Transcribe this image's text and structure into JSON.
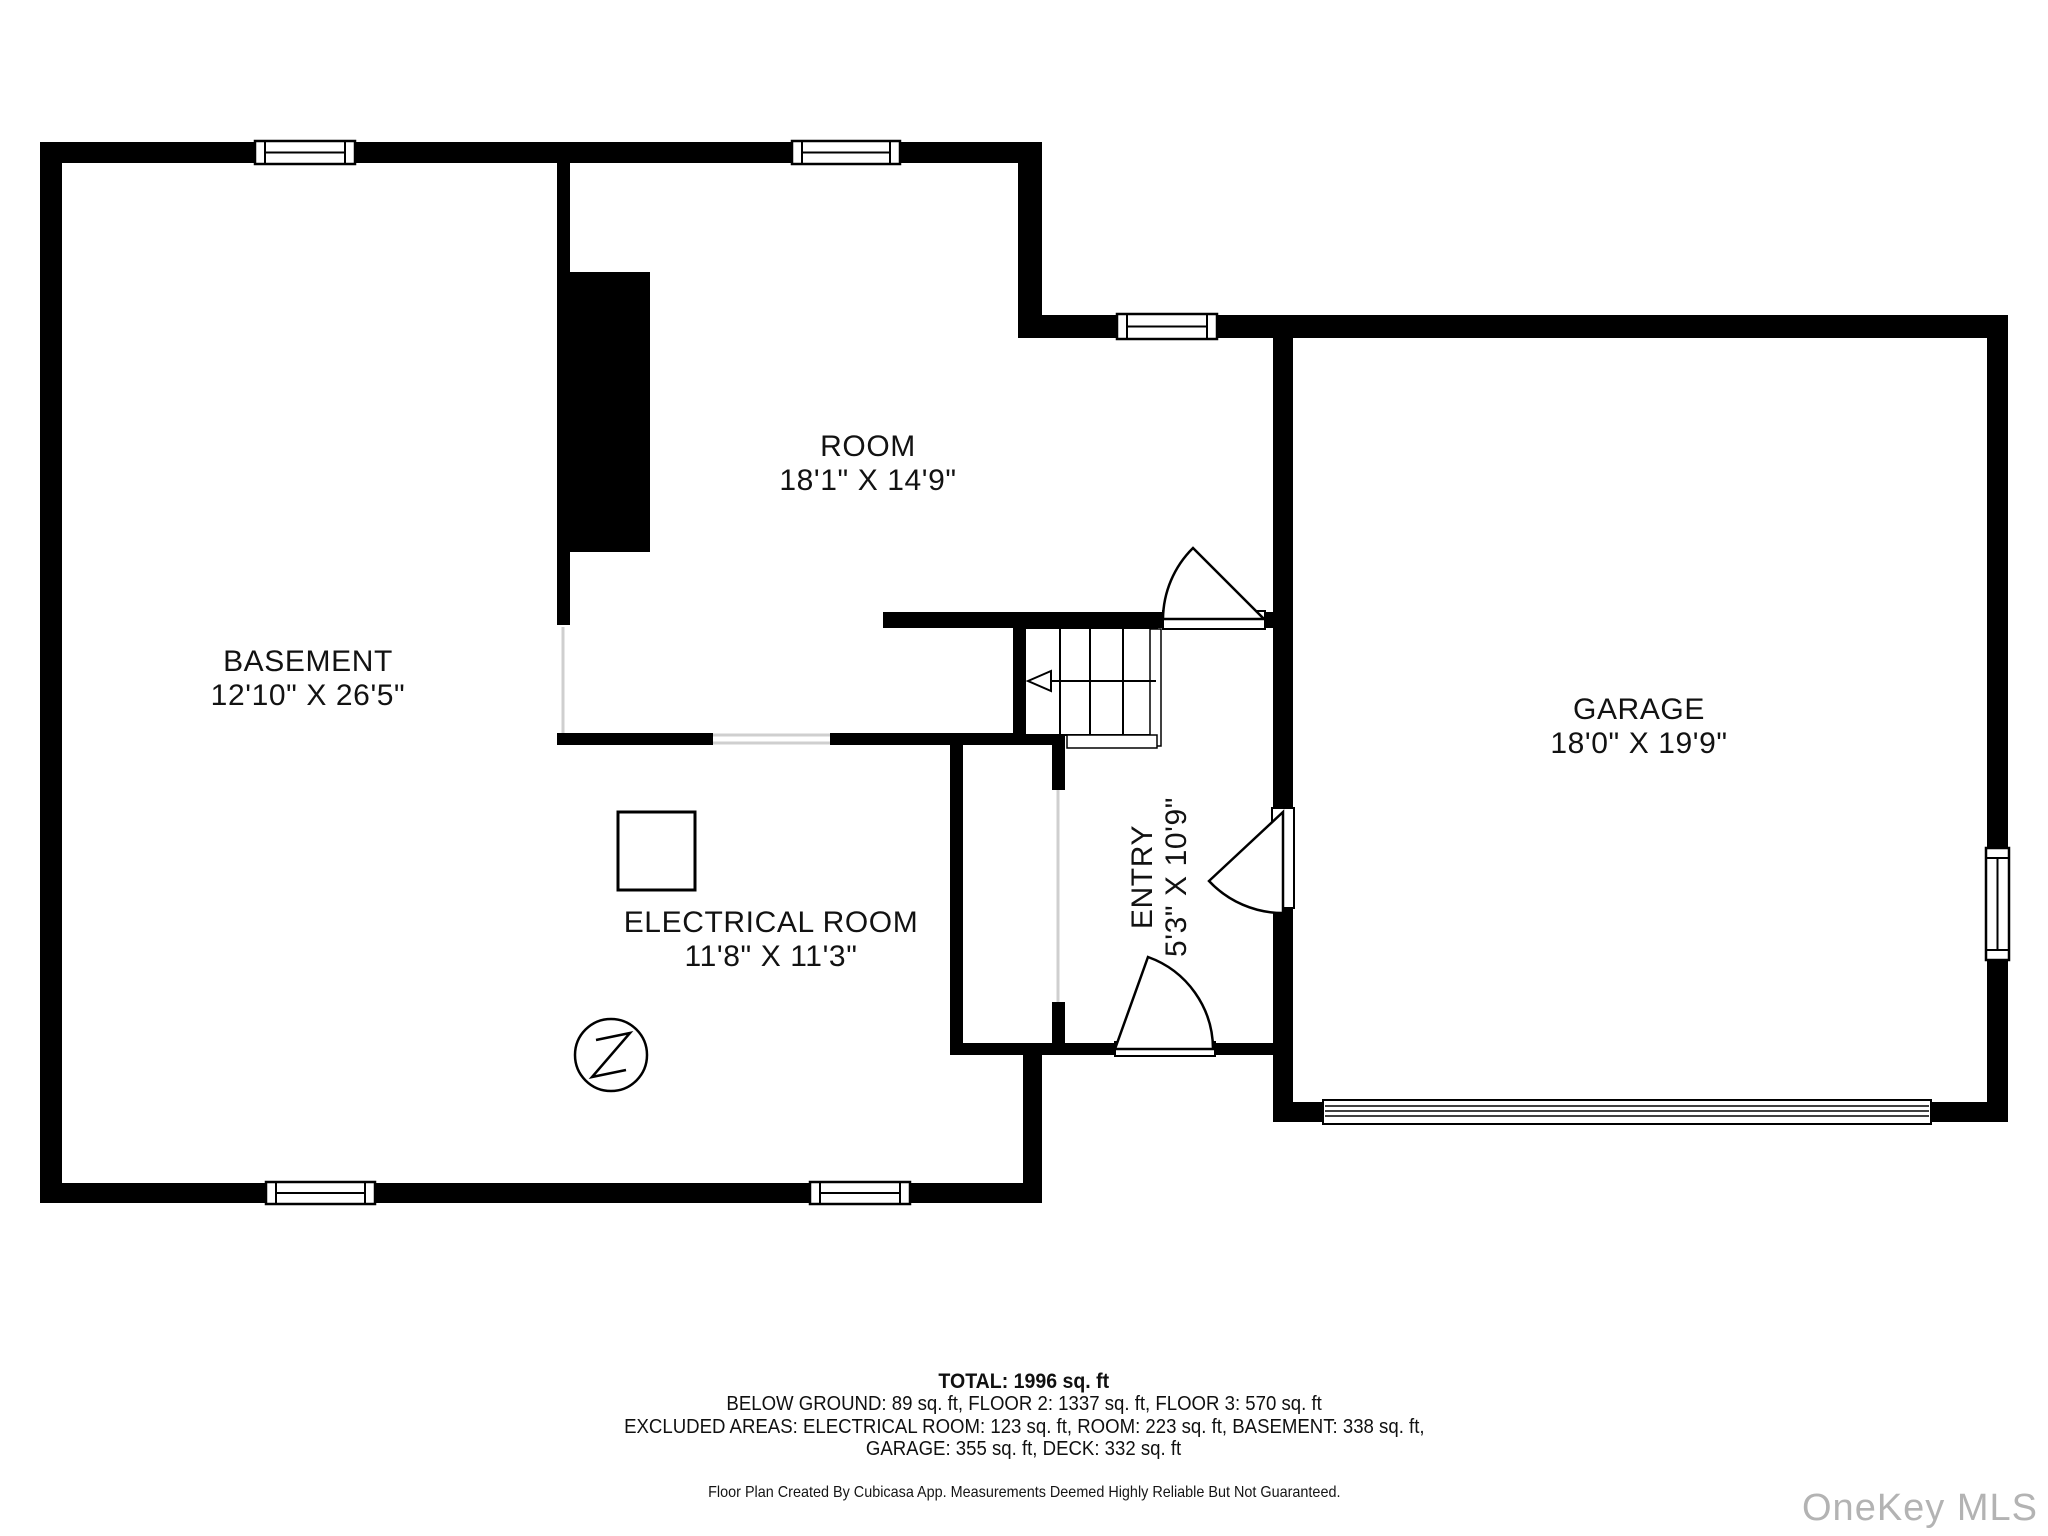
{
  "floor_plan": {
    "rooms": [
      {
        "name": "BASEMENT",
        "dims": "12'10\" X 26'5\""
      },
      {
        "name": "ROOM",
        "dims": "18'1\" X 14'9\""
      },
      {
        "name": "ELECTRICAL ROOM",
        "dims": "11'8\" X 11'3\""
      },
      {
        "name": "ENTRY",
        "dims": "5'3\" X 10'9\""
      },
      {
        "name": "GARAGE",
        "dims": "18'0\" X 19'9\""
      }
    ],
    "summary": {
      "total": "TOTAL: 1996 sq. ft",
      "line2": "BELOW GROUND: 89 sq. ft, FLOOR 2: 1337 sq. ft, FLOOR 3: 570 sq. ft",
      "line3": "EXCLUDED AREAS: ELECTRICAL ROOM: 123 sq. ft, ROOM: 223 sq. ft, BASEMENT: 338 sq. ft,",
      "line4": "GARAGE: 355 sq. ft, DECK: 332 sq. ft"
    },
    "disclaimer": "Floor Plan Created By Cubicasa App. Measurements Deemed Highly Reliable But Not Guaranteed.",
    "watermark": "OneKey MLS",
    "icons": {
      "electrical_symbol": "lightning-bolt-circle",
      "stairs_direction": "left-arrow"
    },
    "colors": {
      "wall": "#000000",
      "background": "#ffffff",
      "label_text": "#121212",
      "watermark": "#b3b3b3",
      "open_boundary": "#cfcfcf"
    }
  }
}
